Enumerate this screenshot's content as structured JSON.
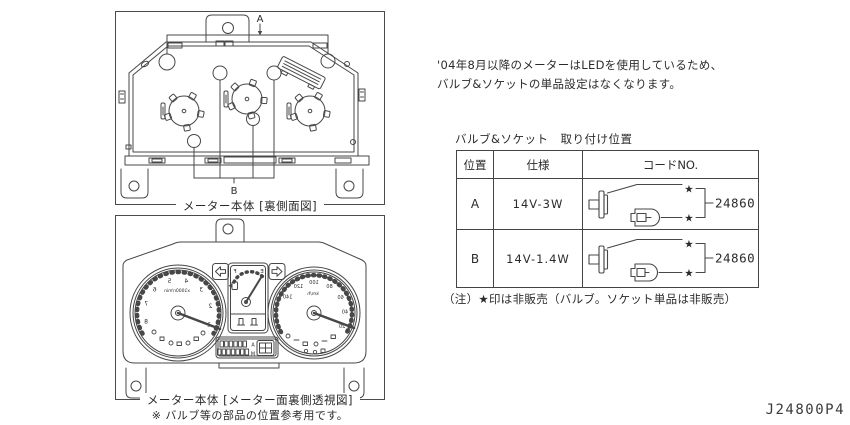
{
  "page": {
    "part_number": "J24800P4",
    "colors": {
      "background": "#ffffff",
      "line": "#474747",
      "text": "#2b2b2b"
    }
  },
  "intro": {
    "line1": "'04年8月以降のメーターはLEDを使用しているため、",
    "line2": "バルブ&ソケットの単品設定はなくなります。"
  },
  "figures": {
    "back": {
      "caption": "メーター本体 [裏側面図]",
      "label_a": "A",
      "label_b": "B"
    },
    "front": {
      "caption": "メーター本体 [メーター面裏側透視図]",
      "note": "※ バルブ等の部品の位置参考用です。",
      "tachometer_unit": "x1000r/min",
      "tachometer_numbers": [
        "1",
        "2",
        "3",
        "4",
        "5",
        "6",
        "7",
        "8"
      ],
      "speedometer_unit": "km/h",
      "speedometer_numbers": [
        "20",
        "40",
        "60",
        "80",
        "100",
        "120",
        "140"
      ],
      "fuel_full": "F",
      "fuel_empty": "E",
      "odometer_letters": [
        "A",
        "M"
      ]
    }
  },
  "table": {
    "title": "バルブ&ソケット　取り付け位置",
    "headers": {
      "position": "位置",
      "spec": "仕様",
      "code": "コードNO."
    },
    "star": "★",
    "rows": [
      {
        "position": "A",
        "spec": "14V-3W",
        "code": "24860P"
      },
      {
        "position": "B",
        "spec": "14V-1.4W",
        "code": "24860PA"
      }
    ],
    "note": "（注）★印は非販売（バルブ。ソケット単品は非販売）"
  }
}
